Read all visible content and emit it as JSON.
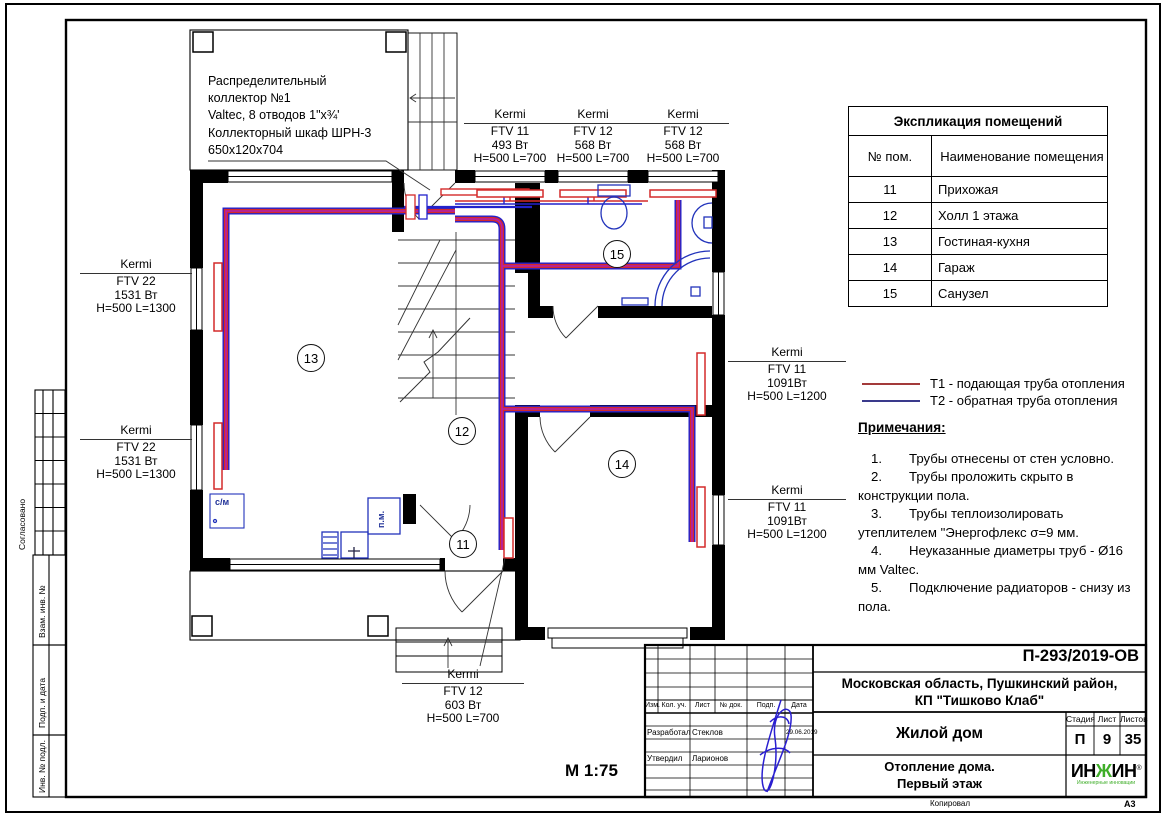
{
  "sheet": {
    "scale": "М 1:75",
    "format": "А3",
    "copy_label": "Копировал"
  },
  "side_strip": {
    "agreed": "Согласовано",
    "replace_inv": "Взам. инв. №",
    "sign_date": "Подп. и дата",
    "inv_orig": "Инв. № подл."
  },
  "plan": {
    "collector_note_lines": [
      "Распределительный",
      "коллектор №1",
      "Valtec, 8 отводов 1\"х¾'",
      "Коллекторный шкаф ШРН-3",
      "650х120х704"
    ],
    "room_numbers": {
      "r11": "11",
      "r12": "12",
      "r13": "13",
      "r14": "14",
      "r15": "15"
    },
    "washer_label": "с/м",
    "dishwasher_label": "п.м.",
    "radiators": {
      "left_top": {
        "brand": "Kermi",
        "model": "FTV 22",
        "power": "1531 Вт",
        "dims": "H=500 L=1300"
      },
      "left_bottom": {
        "brand": "Kermi",
        "model": "FTV 22",
        "power": "1531 Вт",
        "dims": "H=500 L=1300"
      },
      "top_1": {
        "brand": "Kermi",
        "model": "FTV 11",
        "power": "493 Вт",
        "dims": "H=500 L=700"
      },
      "top_2": {
        "brand": "Kermi",
        "model": "FTV 12",
        "power": "568 Вт",
        "dims": "H=500 L=700"
      },
      "top_3": {
        "brand": "Kermi",
        "model": "FTV 12",
        "power": "568 Вт",
        "dims": "H=500 L=700"
      },
      "right_top": {
        "brand": "Kermi",
        "model": "FTV 11",
        "power": "1091Вт",
        "dims": "H=500 L=1200"
      },
      "right_bottom": {
        "brand": "Kermi",
        "model": "FTV 11",
        "power": "1091Вт",
        "dims": "H=500 L=1200"
      },
      "bottom": {
        "brand": "Kermi",
        "model": "FTV 12",
        "power": "603 Вт",
        "dims": "H=500 L=700"
      }
    }
  },
  "room_table": {
    "title": "Экспликация помещений",
    "col_num": "№ пом.",
    "col_name": "Наименование помещения",
    "rows": [
      {
        "num": "11",
        "name": "Прихожая"
      },
      {
        "num": "12",
        "name": "Холл 1 этажа"
      },
      {
        "num": "13",
        "name": "Гостиная-кухня"
      },
      {
        "num": "14",
        "name": "Гараж"
      },
      {
        "num": "15",
        "name": "Санузел"
      }
    ]
  },
  "legend": {
    "t1_label": "Т1 - подающая труба отопления",
    "t2_label": "Т2 - обратная труба отопления",
    "t1_color": "#a33a3a",
    "t2_color": "#3a3a8c",
    "pipe_supply_color": "#d42a2a",
    "pipe_return_color": "#2222cc"
  },
  "notes": {
    "title": "Примечания:",
    "items": [
      {
        "num": "1.",
        "text": "Трубы отнесены от стен условно."
      },
      {
        "num": "2.",
        "text": "Трубы проложить скрыто в конструкции пола."
      },
      {
        "num": "3.",
        "text": "Трубы теплоизолировать утеплителем \"Энергофлекс σ=9 мм."
      },
      {
        "num": "4.",
        "text": "Неуказанные диаметры труб - Ø16 мм Valtec."
      },
      {
        "num": "5.",
        "text": "Подключение радиаторов - снизу из пола."
      }
    ]
  },
  "title_block": {
    "doc_number": "П-293/2019-ОВ",
    "project_line1": "Московская область, Пушкинский район,",
    "project_line2": "КП \"Тишково Клаб\"",
    "object_name": "Жилой дом",
    "drawing_title_line1": "Отопление дома.",
    "drawing_title_line2": "Первый этаж",
    "stage_label": "Стадия",
    "sheet_label": "Лист",
    "sheets_label": "Листов",
    "stage": "П",
    "sheet": "9",
    "sheets": "35",
    "col_izm": "Изм.",
    "col_kol": "Кол. уч.",
    "col_list": "Лист",
    "col_doc": "№ док.",
    "col_sign": "Подп.",
    "col_date": "Дата",
    "role_developed": "Разработал",
    "name_developed": "Стеклов",
    "role_approved": "Утвердил",
    "name_approved": "Ларионов",
    "date": "29.06.2019",
    "logo": {
      "part1": "ИН",
      "part2": "Ж",
      "part3": "ИН",
      "reg": "®",
      "subtitle": "Инженерные инновации",
      "green": "#3fae29"
    }
  }
}
